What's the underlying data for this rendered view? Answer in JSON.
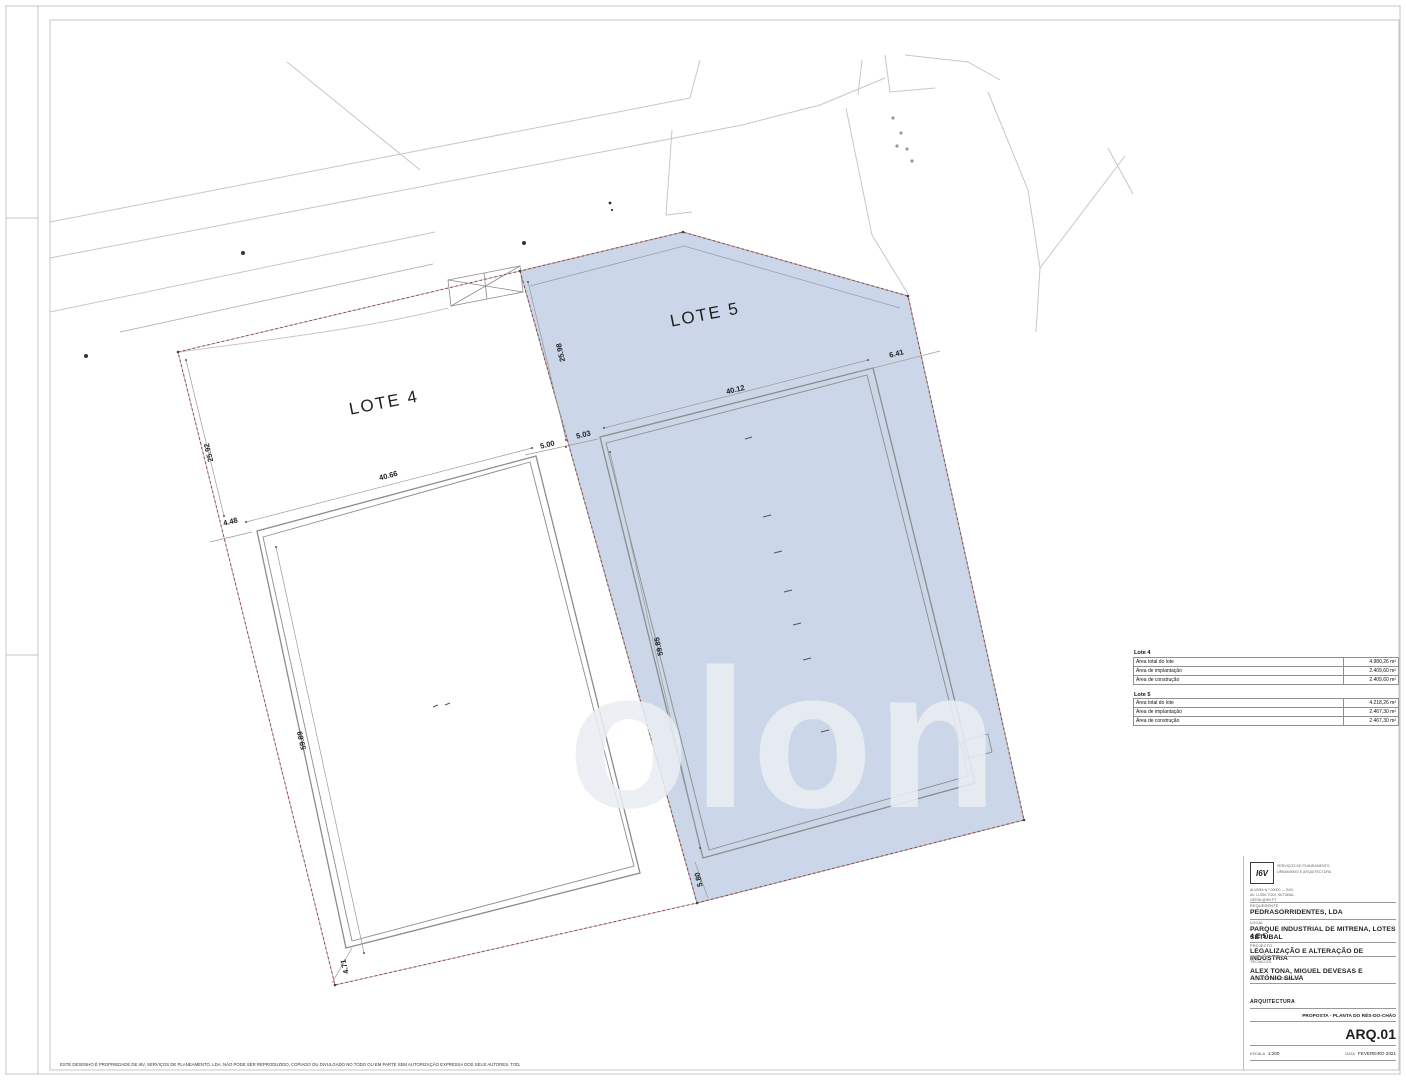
{
  "plan": {
    "lote4_label": "LOTE 4",
    "lote5_label": "LOTE 5",
    "dims": {
      "lote4_boundary_top_left": "25.92",
      "lote4_building_width": "40.66",
      "lote4_setback_top_left": "4.48",
      "lote4_building_length": "59.89",
      "lote4_setback_bottom_left": "4.71",
      "lote5_boundary_top_left": "25.98",
      "lote5_setback_left_outer": "5.00",
      "lote5_setback_left_inner": "5.03",
      "lote5_building_width": "40.12",
      "lote5_setback_top_right": "6.41",
      "lote5_building_length": "59.85",
      "lote5_setback_bottom_left": "5.80"
    },
    "colors": {
      "lote5_fill": "#cbd7e8",
      "lote5_edge": "#7e8ba2",
      "boundary_dash": "#a2423b",
      "building_line": "#8c8c8c",
      "road_line": "#c7c7c7"
    }
  },
  "watermark": "olon",
  "areas_table": {
    "lote4": {
      "title": "Lote 4",
      "rows": [
        {
          "label": "Área total do lote",
          "value": "4.980,26 m²"
        },
        {
          "label": "Área de implantação",
          "value": "2.409,60 m²"
        },
        {
          "label": "Área de construção",
          "value": "2.409,60 m²"
        }
      ]
    },
    "lote5": {
      "title": "Lote 5",
      "rows": [
        {
          "label": "Área total do lote",
          "value": "4.218,26 m²"
        },
        {
          "label": "Área de implantação",
          "value": "2.467,30 m²"
        },
        {
          "label": "Área de construção",
          "value": "2.467,30 m²"
        }
      ]
    }
  },
  "title_block": {
    "logo_text": "I6V",
    "logo_caption_1": "SERVIÇOS DE PLANEAMENTO",
    "logo_caption_2": "URBANISMO E ARQUITECTURA",
    "address_line_1": "ALVARÁ N.º 00000 — INCI",
    "address_line_2": "AV. LUÍSA TODI, SETÚBAL",
    "address_line_3": "GERAL@I6V.PT",
    "labels": {
      "requerente": "REQUERENTE",
      "local": "LOCAL",
      "projecto": "PROJECTO",
      "tecnicos": "TÉCNICOS",
      "tecnico_responsavel": "TÉCNICO RESPONSÁVEL",
      "escala": "ESCALA",
      "data": "DATA"
    },
    "requerente": "PEDRASORRIDENTES, LDA",
    "local_line_1": "PARQUE INDUSTRIAL DE MITRENA, LOTES 4 E 5",
    "local_line_2": "SETÚBAL",
    "projecto": "LEGALIZAÇÃO E ALTERAÇÃO DE INDÚSTRIA",
    "tecnicos": "ALEX TONA, MIGUEL DEVESAS E ANTÓNIO SILVA",
    "especialidade": "ARQUITECTURA",
    "drawing_title": "PROPOSTA - PLANTA DO RÉS-DO-CHÃO",
    "sheet_number": "ARQ.01",
    "escala_value": "1:200",
    "data_value": "FEVEREIRO 2021"
  },
  "footer_note": "ESTE DESENHO É PROPRIEDADE DE I6V, SERVIÇOS DE PLANEAMENTO, LDA. NÃO PODE SER REPRODUZIDO, COPIADO OU DIVULGADO NO TODO OU EM PARTE SEM AUTORIZAÇÃO EXPRESSA DOS SEUS AUTORES. TODAS AS DIMENSÕES DEVERÃO SER CONFIRMADAS EM OBRA. EM CASO DE DÚVIDA CONSULTAR OS AUTORES DO PROJECTO."
}
